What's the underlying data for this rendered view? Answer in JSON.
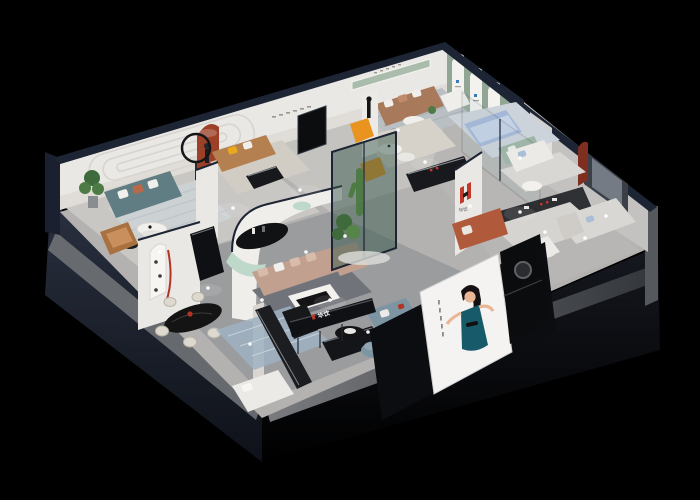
{
  "scene": {
    "title": "Isometric 3D cutaway render of a furniture showroom on a black background",
    "background_color": "#000000"
  },
  "branding": {
    "logo_letter": "H",
    "logo_text_cn": "华饮",
    "logo_red": "#c0392b",
    "logo_black": "#1b1b1b"
  },
  "poster": {
    "subject": "woman in teal halter dress",
    "bg": "#f4f3f1",
    "dress": "#175a69",
    "hair": "#171013",
    "skin": "#e9b696"
  },
  "palette": {
    "outer_wall": "#262d3d",
    "outer_wall_dark": "#10131b",
    "cut_band": "#85888c",
    "wall_white": "#eae8e4",
    "wall_shadow": "#d7d4cf",
    "trim_navy": "#1d2433",
    "floor_light": "#c8c7c4",
    "floor_mid": "#b3b2b0",
    "floor_dark": "#97989a",
    "sage": "#92a695",
    "sage_light": "#aabcab",
    "terracotta": "#9c4128",
    "rust_sofa": "#b0593b",
    "brown_sofa": "#a87a5b",
    "caramel_sofa": "#b5804f",
    "teal_sofa": "#5f7d82",
    "tan_sofa": "#c2a08f",
    "mint": "#bed8ca",
    "slate_blue": "#7d95a3",
    "periwinkle": "#a5b8d8",
    "orange": "#e8941f",
    "yellow_pillow": "#e8a91f",
    "plant_green": "#4e7a46",
    "plant_dark": "#3f6a3c",
    "glass_green": "#39594d",
    "blue_pillow": "#a9bdd6",
    "black_furniture": "#141518",
    "white_furniture": "#efeeea",
    "cream": "#ded9ce",
    "rug_blue": "#9fb2c2",
    "accent_red": "#b03527"
  },
  "rooms": [
    {
      "id": "lounge-teal",
      "label": "teal sofa lounge"
    },
    {
      "id": "lounge-caramel",
      "label": "caramel sofa room"
    },
    {
      "id": "lounge-brown",
      "label": "brown leather sofa room"
    },
    {
      "id": "arch-gallery",
      "label": "sage arch gallery wall"
    },
    {
      "id": "bedroom-display",
      "label": "periwinkle bed display"
    },
    {
      "id": "sofa-gallery-right",
      "label": "white sofa gallery"
    },
    {
      "id": "center-lounge",
      "label": "tan sectional lounge"
    },
    {
      "id": "dining-display",
      "label": "black marble dining display"
    },
    {
      "id": "front-bedroom",
      "label": "front bedroom display"
    },
    {
      "id": "reception",
      "label": "reception with brand counter"
    }
  ]
}
